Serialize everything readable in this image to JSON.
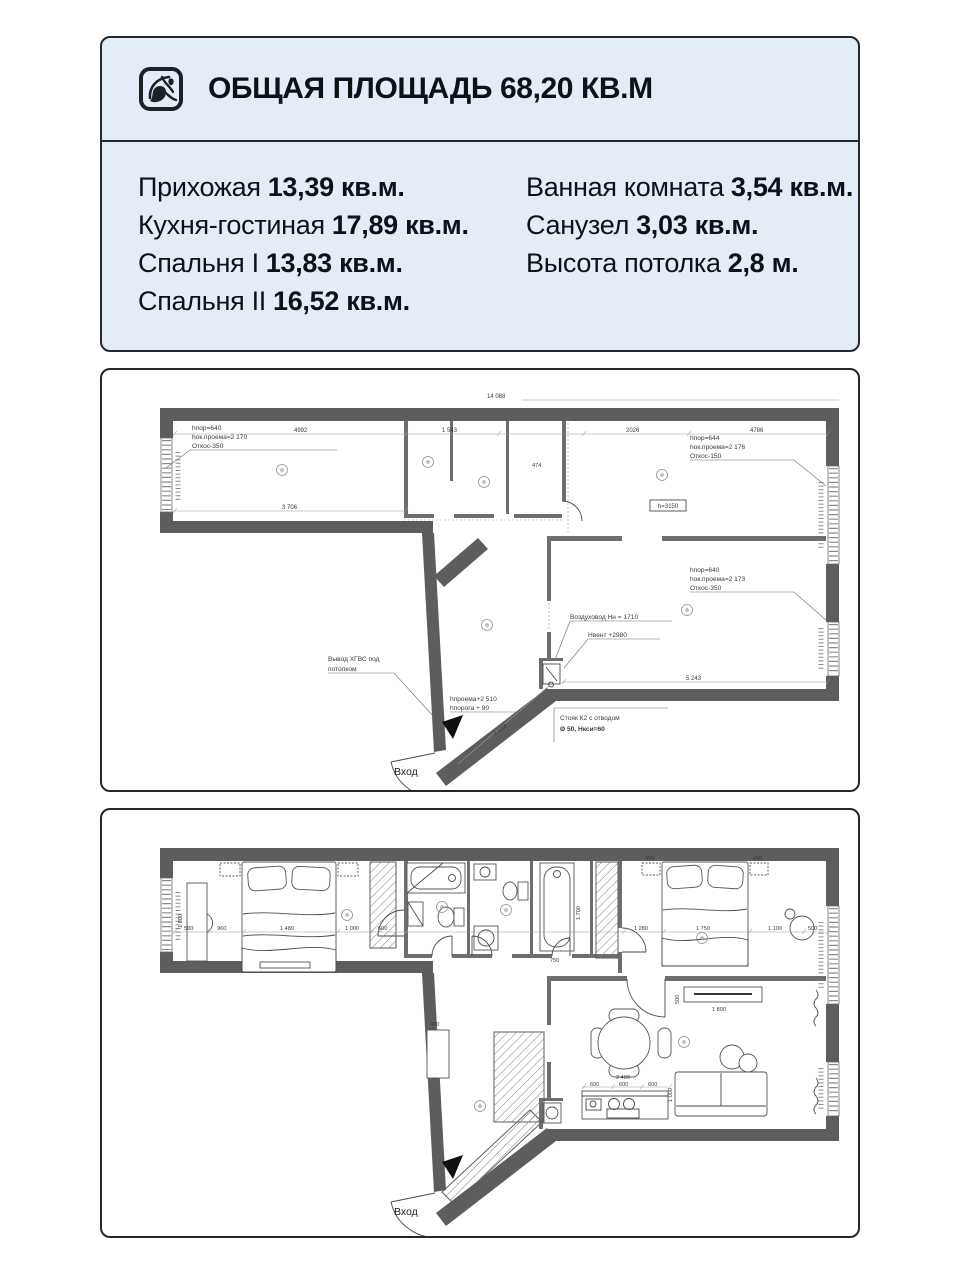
{
  "header": {
    "title": "ОБЩАЯ ПЛОЩАДЬ 68,20 КВ.М"
  },
  "areas": {
    "col_left": [
      {
        "label": "Прихожая",
        "value": "13,39 кв.м."
      },
      {
        "label": "Кухня-гостиная",
        "value": "17,89 кв.м."
      },
      {
        "label": "Спальня I",
        "value": "13,83 кв.м."
      },
      {
        "label": "Спальня II",
        "value": "16,52 кв.м."
      }
    ],
    "col_right": [
      {
        "label": "Ванная комната",
        "value": "3,54 кв.м."
      },
      {
        "label": "Санузел",
        "value": "3,03 кв.м."
      },
      {
        "label": "Высота потолка",
        "value": "2,8 м."
      }
    ]
  },
  "plan_technical": {
    "window_note_left": [
      "hпор=640",
      "hок.проема=2 170",
      "Откос-350"
    ],
    "window_note_right_top": [
      "hпор=644",
      "hок.проема=2 176",
      "Откос-150"
    ],
    "window_note_right_mid": [
      "hпор=640",
      "hок.проема=2 173",
      "Откос-350"
    ],
    "ceiling_box": "h=3150",
    "duct_note": "Воздуховод Нн = 1710",
    "vent_note": "Нвент +2980",
    "hgvs_note_line1": "Вывод ХГВС под",
    "hgvs_note_line2": "потолком",
    "opening_note_line1": "hпроема+2 510",
    "opening_note_line2": "hпорога + 90",
    "riser_note_line1": "Стояк К2 с отводом",
    "riser_note_line2": "Ø 50, Нкси=60",
    "entry_label": "Вход",
    "dims": {
      "total_top": "14 088",
      "kitchen_top": "4992",
      "bath_top": "1 543",
      "hall_top": "2026",
      "bedroom_top": "4786",
      "kitchen_bottom": "3 706",
      "bedroom2_bottom": "5 243",
      "entry_diag": "2 513",
      "closet": "474"
    }
  },
  "plan_furnished": {
    "entry_label": "Вход",
    "dims": {
      "chain_500a": "500",
      "chain_960": "960",
      "chain_1480": "1 480",
      "chain_1000": "1 000",
      "chain_600": "600",
      "chain_1280": "1 280",
      "chain_1750": "1 750",
      "chain_1100": "1 100",
      "chain_500b": "500",
      "nstand_450a": "450",
      "nstand_450b": "450",
      "desk_1800": "1 800",
      "tub_1700": "1 700",
      "tub_750": "750",
      "tv_1800": "1 800",
      "tv_500": "500",
      "counter_2400": "2 400",
      "counter_600a": "600",
      "counter_600b": "600",
      "counter_600c": "600",
      "sofa_1000": "1 000",
      "bench_400": "400"
    }
  }
}
